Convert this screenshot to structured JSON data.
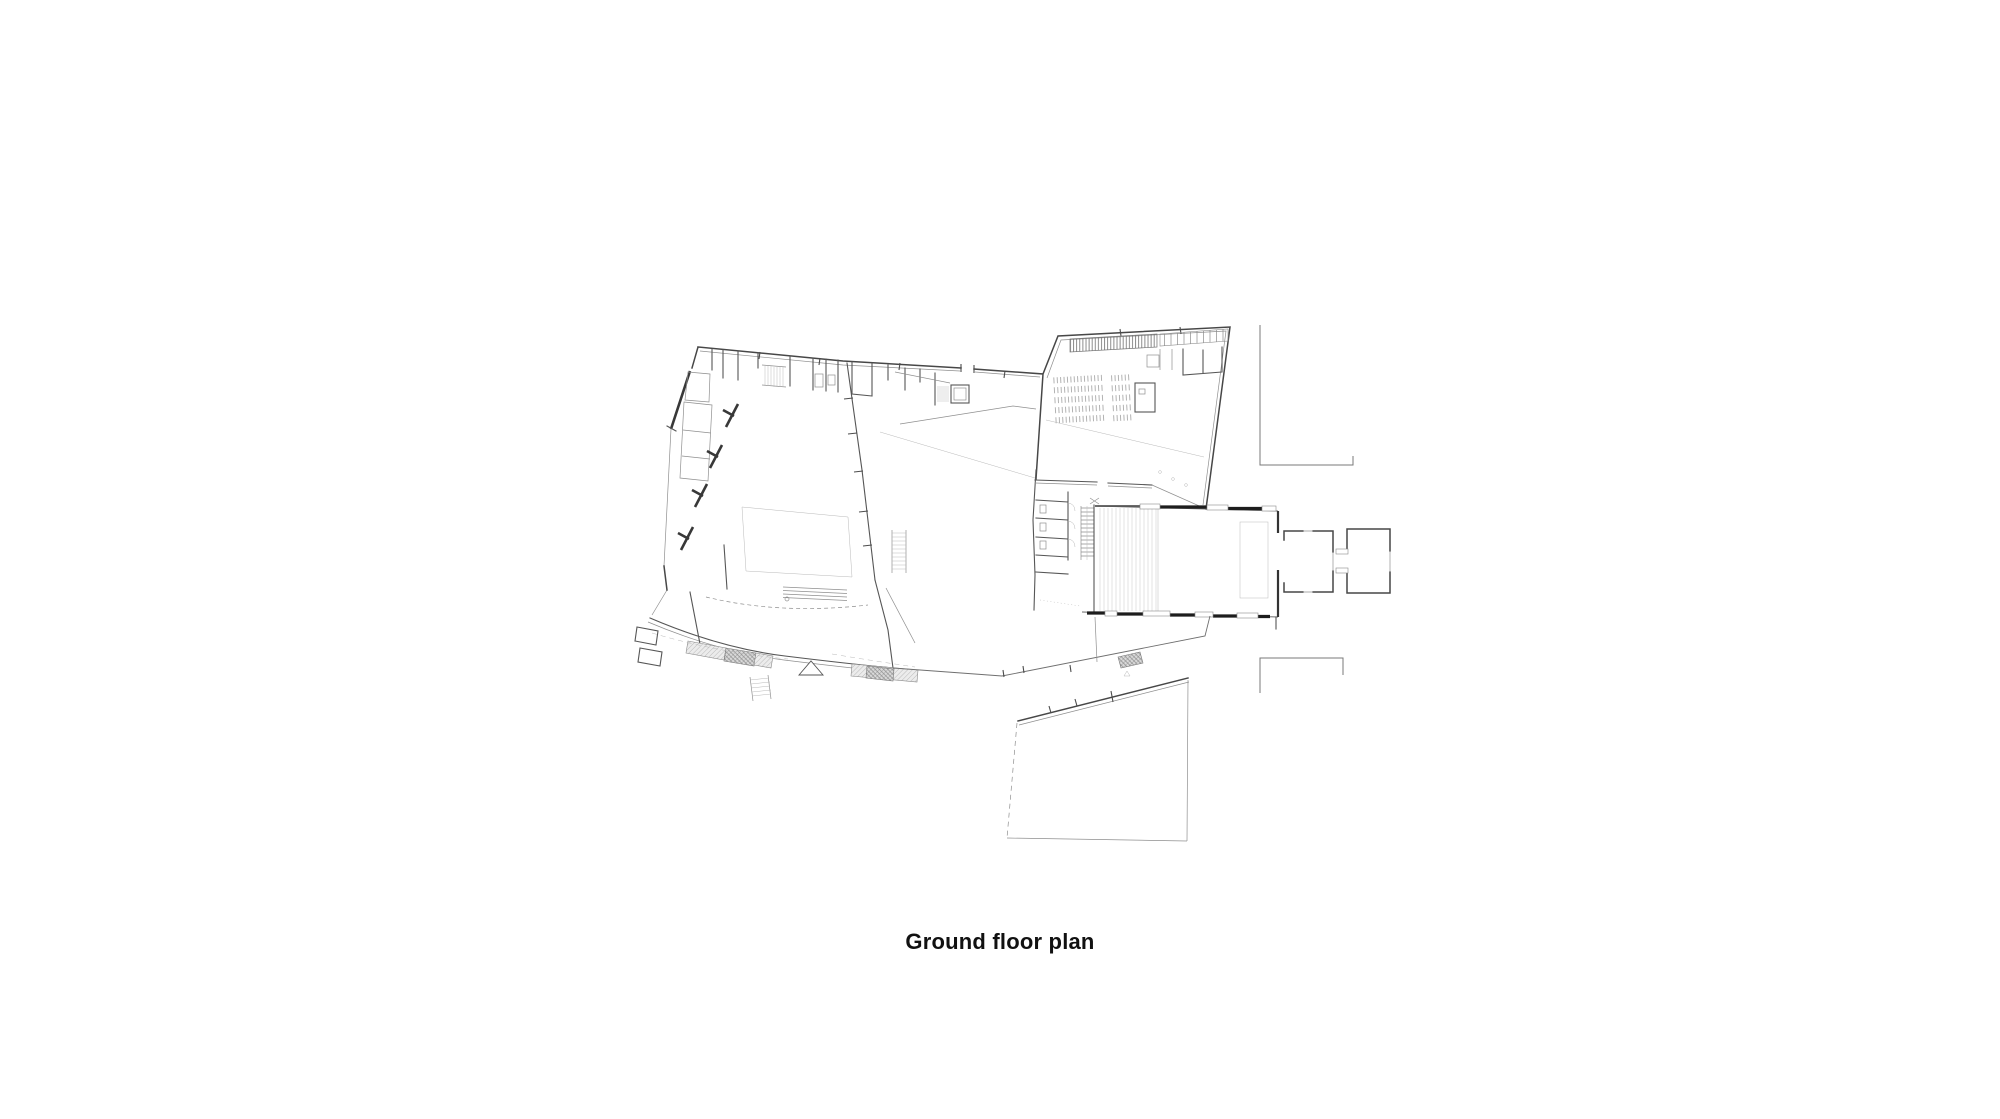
{
  "page": {
    "background_color": "#ffffff"
  },
  "caption": {
    "text": "Ground floor plan",
    "color": "#111111",
    "font_size_px": 22,
    "font_weight": "bold"
  },
  "drawing": {
    "type": "architectural-floor-plan",
    "description": "Ground floor plan line drawing: west building with curved hatched south facade, angled north-east wing with coat hatching and seating rows, rectangular hall with windowed walls and eastern chapel porch, stairs and WC block, walled garden plot to the south, neighbouring wall fragments at right",
    "ink_color": "#474747",
    "light_line_color": "#8f8f8f",
    "faint_line_color": "#b9b9b9",
    "wall_poche_color": "#1d1d1d",
    "hatch_fill_color": "#dcdcdc",
    "hatch_line_color": "#7d7d7d"
  }
}
